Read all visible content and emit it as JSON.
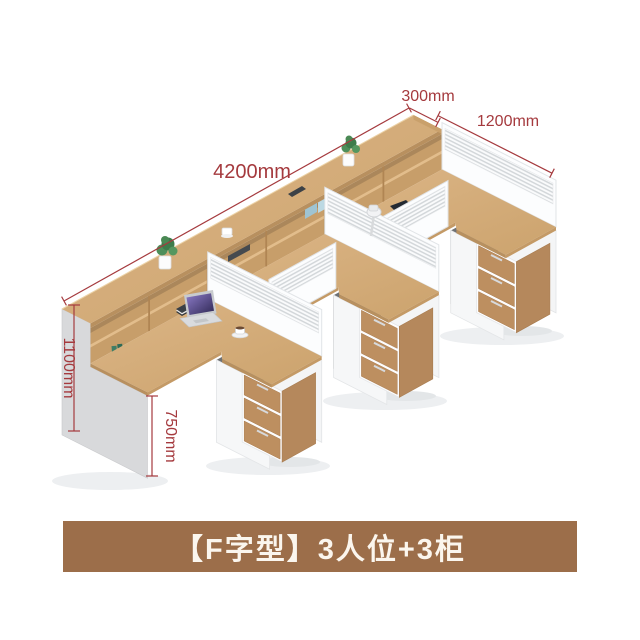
{
  "page": {
    "background": "#ffffff"
  },
  "annotations": {
    "length_4200": "4200mm",
    "depth_300": "300mm",
    "width_1200": "1200mm",
    "height_1100": "1100mm",
    "height_750": "750mm",
    "color": "#a53a3e"
  },
  "caption": {
    "text": "【F字型】3人位+3柜",
    "background": "#9c6e4a",
    "text_color": "#fbf6ee"
  },
  "scene": {
    "objects": [
      "long-counter-with-cubby-shelves",
      "l-shaped-desk-left",
      "l-shaped-desk-middle",
      "l-shaped-desk-right",
      "privacy-screen-left",
      "privacy-screen-middle",
      "privacy-screen-right",
      "desk-divider-screen-a",
      "desk-divider-screen-b",
      "drawer-pedestal-left",
      "drawer-pedestal-middle",
      "drawer-pedestal-right",
      "potted-plant-left",
      "potted-plant-right",
      "laptop",
      "coffee-cup",
      "open-book",
      "desk-lamp",
      "smartphone",
      "notebook",
      "pen-cup"
    ],
    "wood_color": "#d2a873",
    "panel_color": "#f5f6f7",
    "screen_stripe_color": "#d3d7da",
    "drawer_wood_color": "#bd8f60"
  }
}
